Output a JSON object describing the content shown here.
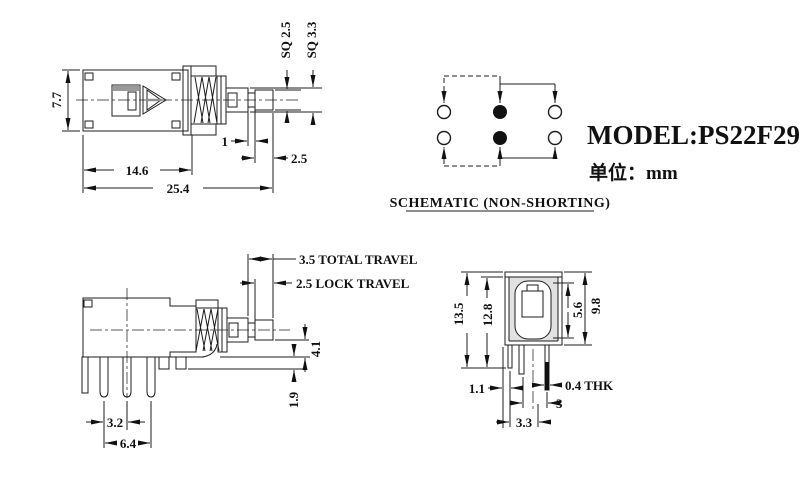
{
  "drawing": {
    "model": "MODEL:PS22F29",
    "unit": "单位：mm",
    "schematic_caption": "SCHEMATIC (NON-SHORTING)"
  },
  "top_view": {
    "body_height": "7.7",
    "body_width": "14.6",
    "overall_length": "25.4",
    "stem_square_small": "SQ 2.5",
    "stem_square_large": "SQ 3.3",
    "step_length": "1",
    "tip_length": "2.5"
  },
  "side_view": {
    "total_travel": "3.5 TOTAL TRAVEL",
    "lock_travel": "2.5 LOCK TRAVEL",
    "plunger_to_base": "4.1",
    "standoff": "1.9",
    "pin_pitch": "3.2",
    "pin_span": "6.4"
  },
  "front_view": {
    "overall_height": "13.5",
    "height_to_base": "12.8",
    "body_height": "9.8",
    "button_size": "5.6",
    "edge_to_pin": "1.1",
    "pin_thickness": "0.4 THK",
    "pin_gap": "3",
    "pin_pitch": "3.3"
  }
}
